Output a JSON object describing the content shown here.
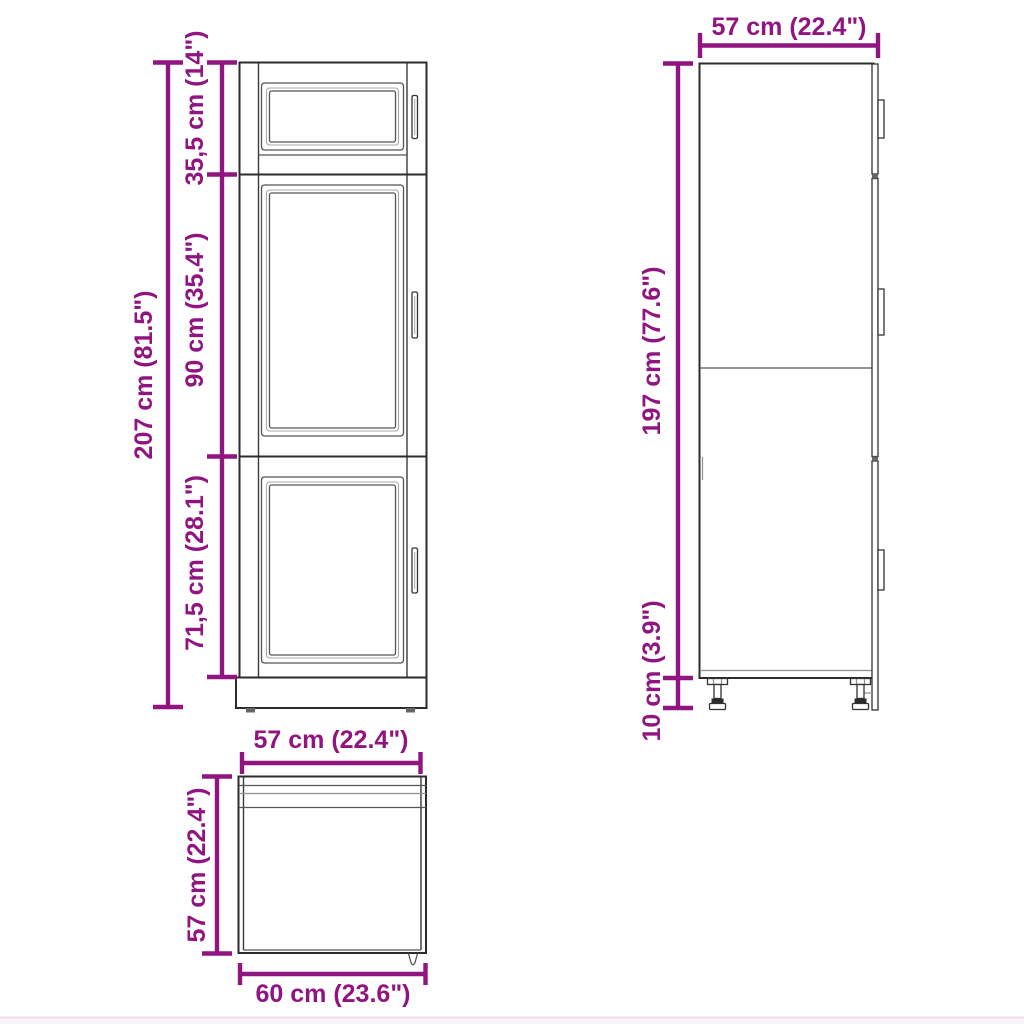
{
  "diagram": {
    "type": "furniture-dimension-diagram",
    "units": [
      "cm",
      "inch"
    ]
  },
  "colors": {
    "dimension_accent": "#901580",
    "outline": "#2e2b2d",
    "background": "#ffffff"
  },
  "views": {
    "front": {
      "total_height": "207 cm (81.5\")",
      "top_section_height": "35,5 cm (14\")",
      "middle_section_height": "90 cm (35.4\")",
      "bottom_section_height": "71,5 cm (28.1\")"
    },
    "side": {
      "depth": "57 cm (22.4\")",
      "body_height": "197 cm (77.6\")",
      "feet_height": "10 cm (3.9\")"
    },
    "top": {
      "body_width": "57 cm (22.4\")",
      "side_depth": "57 cm (22.4\")",
      "overall_width": "60 cm (23.6\")"
    }
  }
}
